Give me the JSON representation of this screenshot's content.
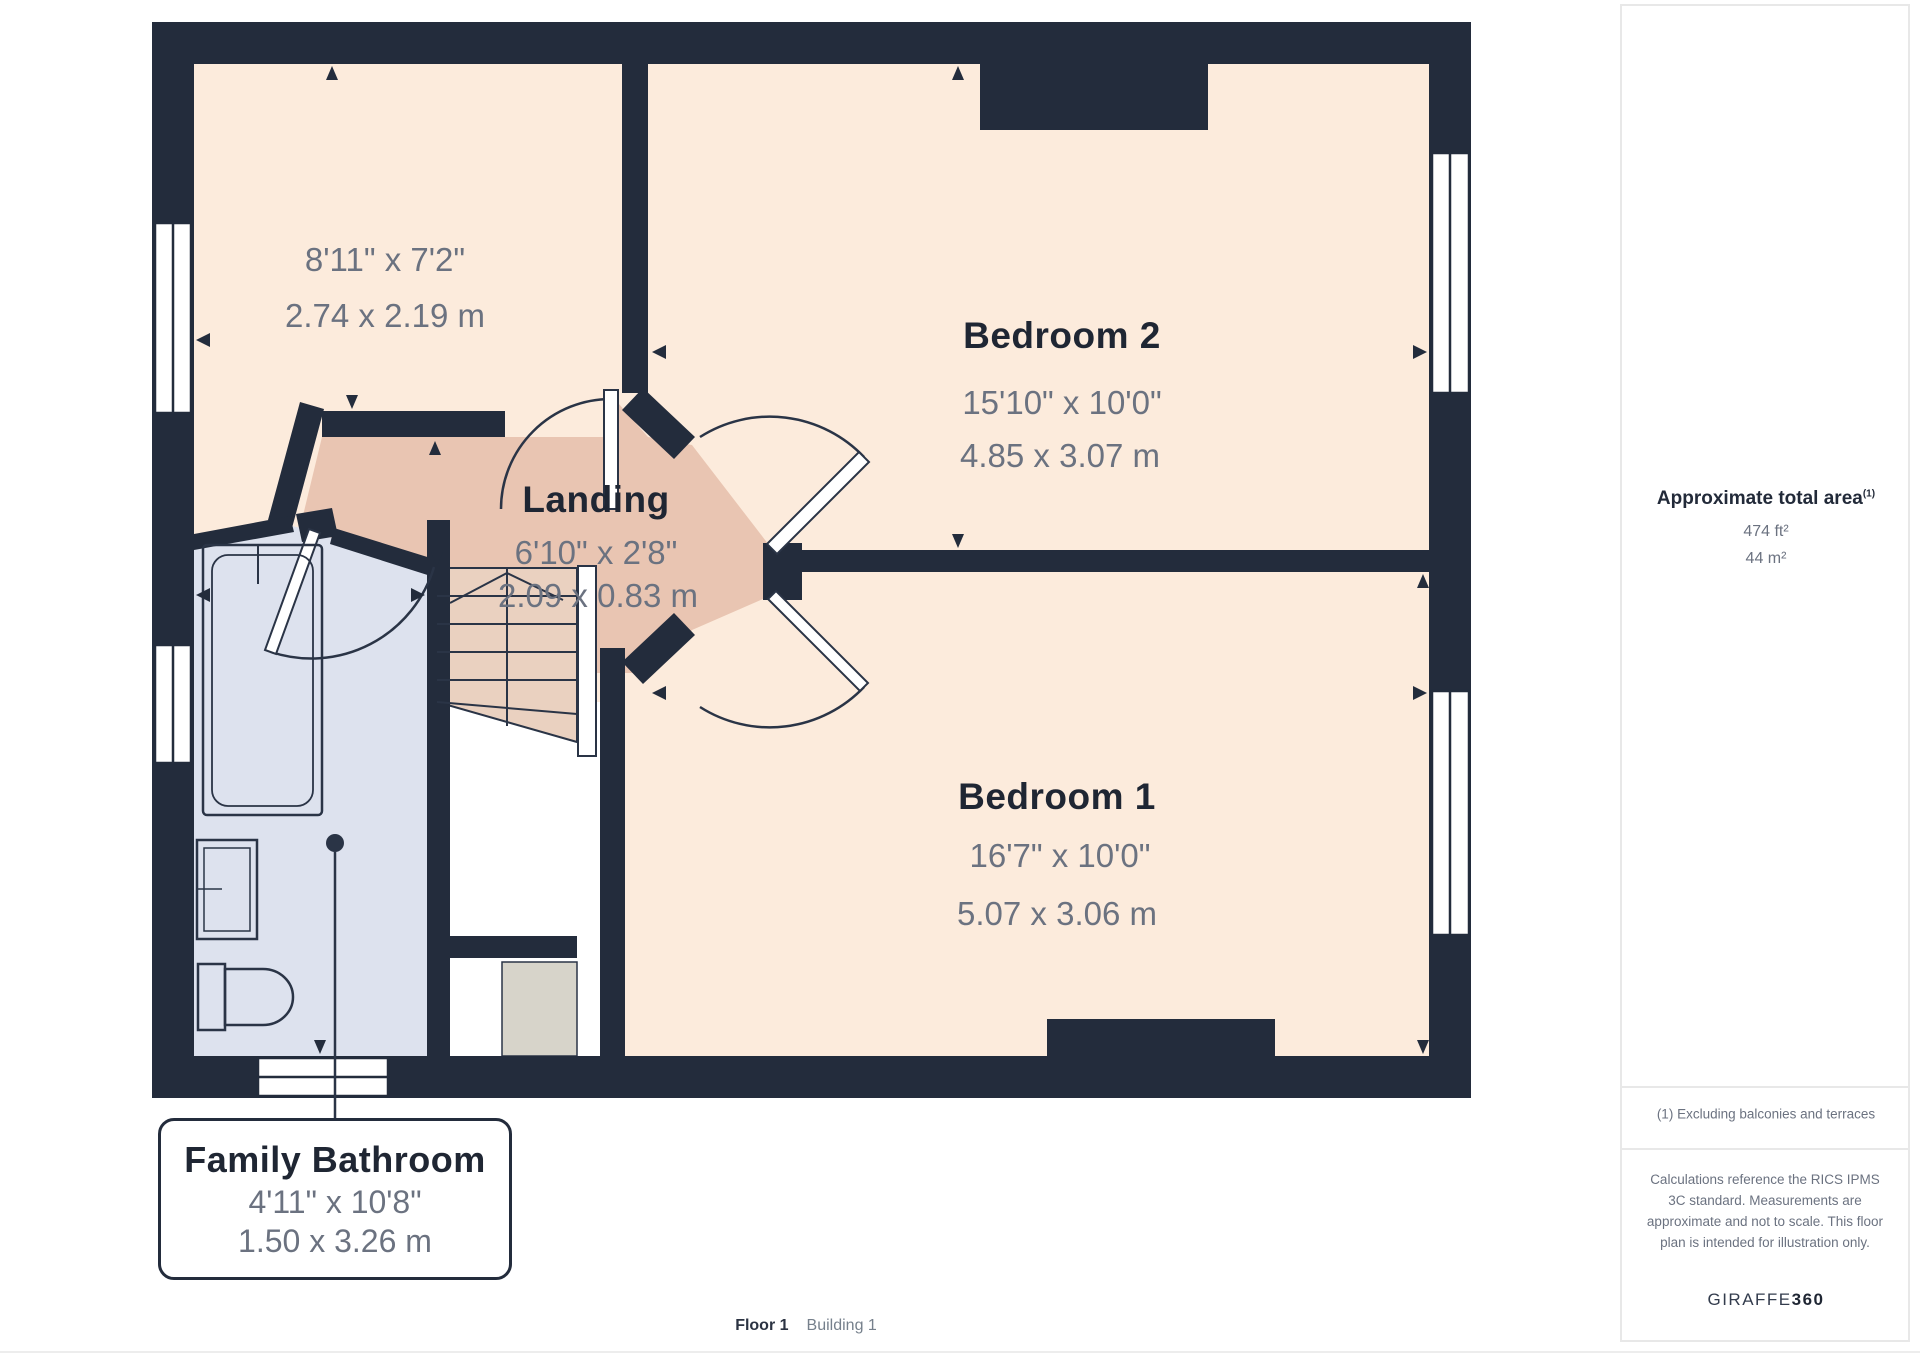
{
  "plan": {
    "rooms": {
      "store": {
        "dim_ft": "8'11\" x 7'2\"",
        "dim_m": "2.74 x 2.19 m"
      },
      "bedroom2": {
        "name": "Bedroom 2",
        "dim_ft": "15'10\" x 10'0\"",
        "dim_m": "4.85 x 3.07 m"
      },
      "landing": {
        "name": "Landing",
        "dim_ft": "6'10\" x 2'8\"",
        "dim_m": "2.09 x 0.83 m"
      },
      "bedroom1": {
        "name": "Bedroom 1",
        "dim_ft": "16'7\" x 10'0\"",
        "dim_m": "5.07 x 3.06 m"
      },
      "bathroom": {
        "name": "Family Bathroom",
        "dim_ft": "4'11\" x 10'8\"",
        "dim_m": "1.50 x 3.26 m"
      }
    },
    "colors": {
      "wall": "#232c3c",
      "room_fill": "#fcebdc",
      "landing_fill": "#ead1c0",
      "bathroom_fill": "#dde2ee",
      "void_fill": "#ffffff",
      "roof_fill": "#d7d4ca",
      "name_text": "#1f2633",
      "dim_text": "#6b7280"
    }
  },
  "sidebar": {
    "area_title": "Approximate total area",
    "area_sup": "(1)",
    "area_ft": "474 ft²",
    "area_m": "44 m²",
    "footnote": "(1) Excluding balconies and terraces",
    "disclaimer": "Calculations reference the RICS IPMS 3C standard. Measurements are approximate and not to scale. This floor plan is intended for illustration only.",
    "brand_name": "GIRAFFE",
    "brand_suffix": "360"
  },
  "footer": {
    "floor": "Floor 1",
    "building": "Building 1"
  }
}
